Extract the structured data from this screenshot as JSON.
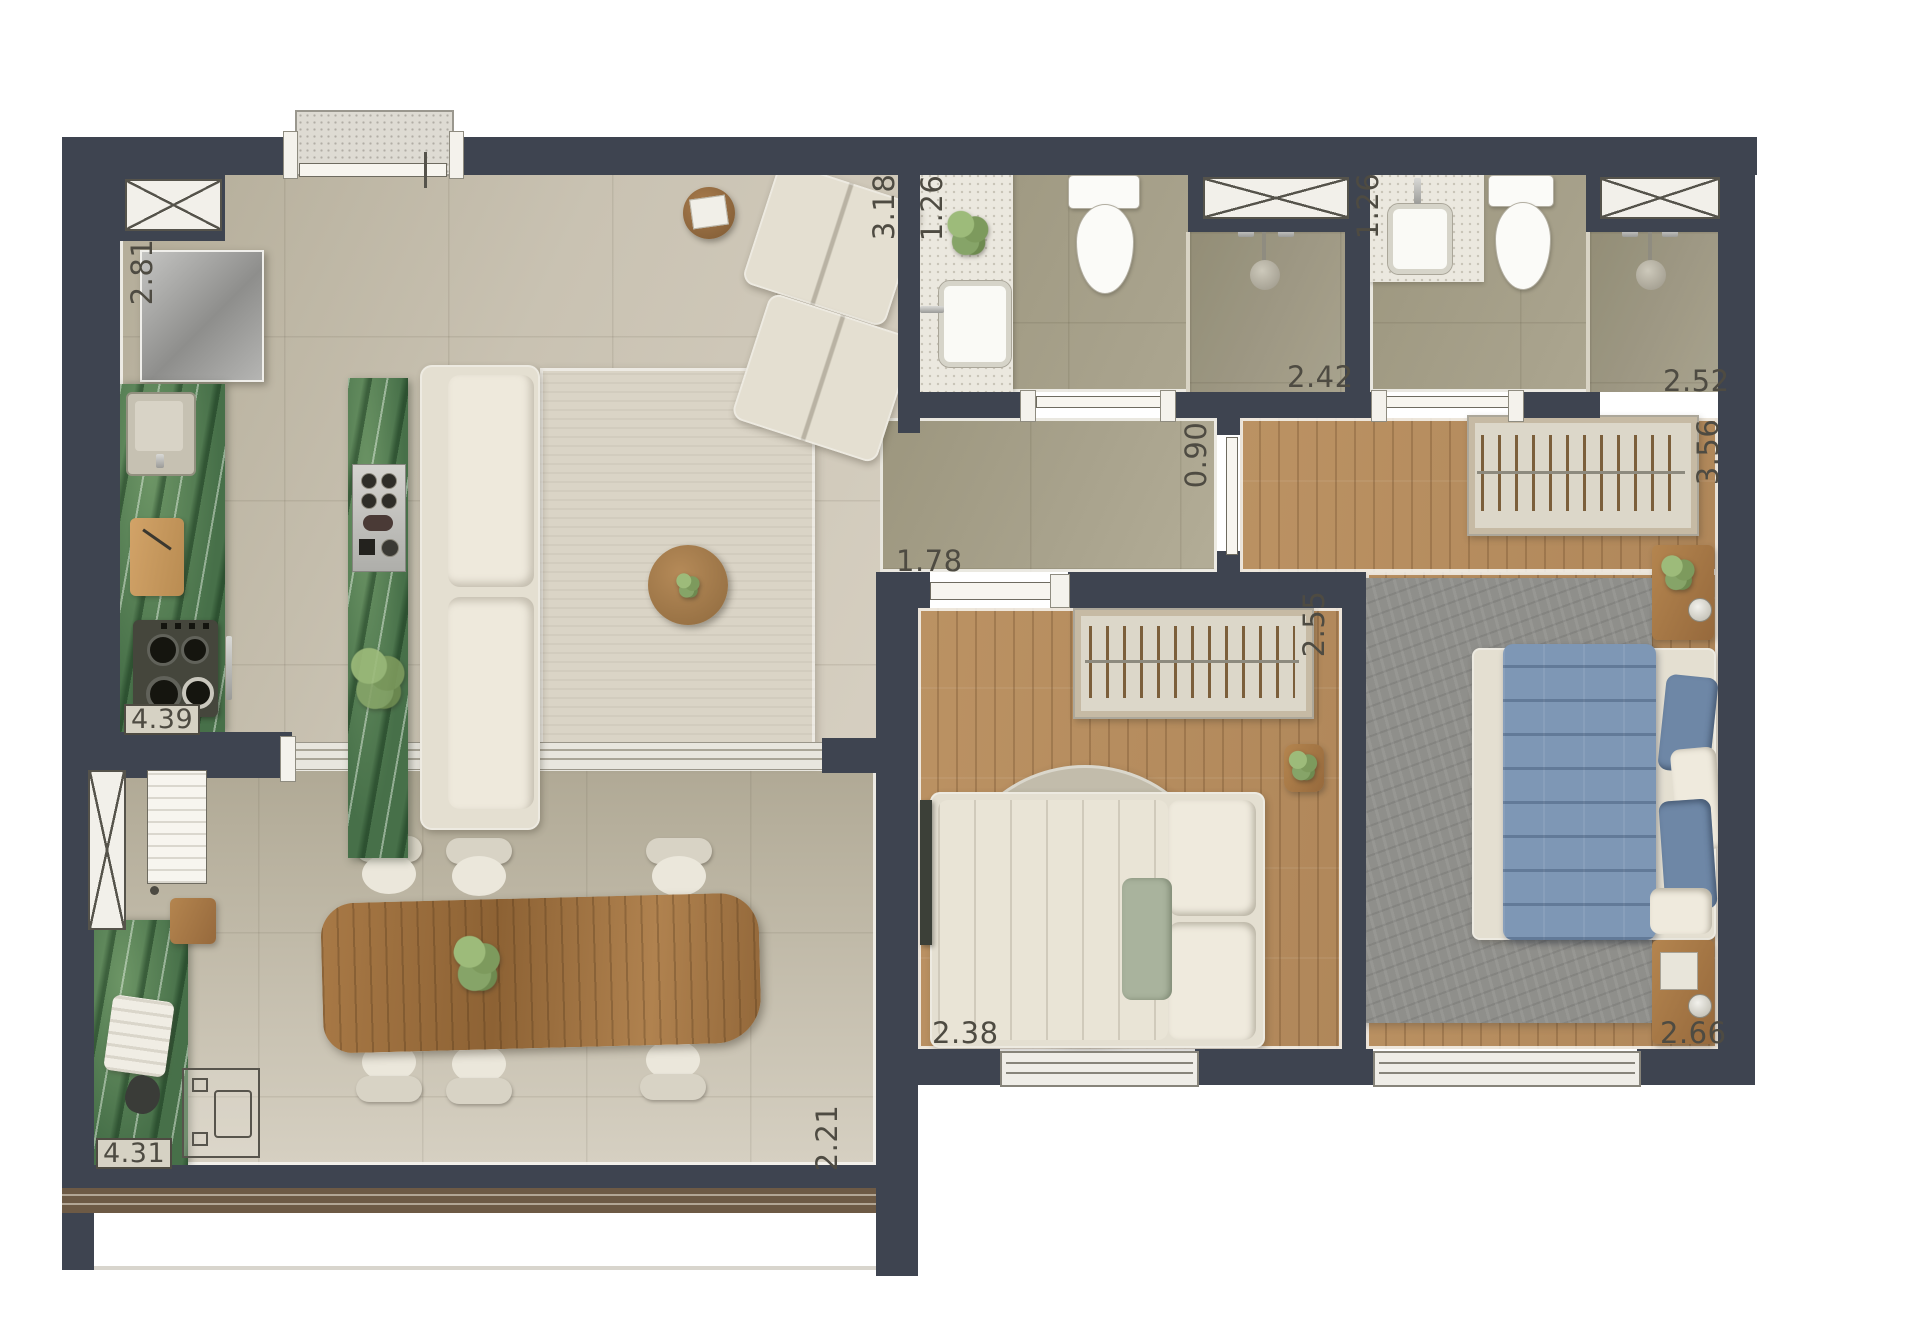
{
  "floorplan": {
    "type": "apartment-top-view-render",
    "labels": {
      "kitchen_depth": "2.81",
      "living_width": "3.18",
      "bath1_depth": "1.26",
      "bath1_width": "2.42",
      "bath2_depth": "1.26",
      "bath2_width": "2.52",
      "hall_width": "0.90",
      "hall_length": "1.78",
      "master_depth": "3.56",
      "bed2_depth": "2.55",
      "kitchen_run": "4.39",
      "bed2_width": "2.38",
      "master_width": "2.66",
      "balcony_run": "4.31",
      "balcony_depth": "2.21"
    },
    "colors": {
      "wall": "#3e4450",
      "marble": "#477049",
      "fabric": "#e4dfd1",
      "blue": "#7e97b5",
      "blueDeep": "#6e87a6",
      "sage": "#a9b39d",
      "rugLiving": "#dad4c6",
      "rugRound": "#c2bcab",
      "rugGray": "#8f8f8b",
      "trackBrown": "#6d5a45",
      "label": "#4e4b42"
    }
  }
}
